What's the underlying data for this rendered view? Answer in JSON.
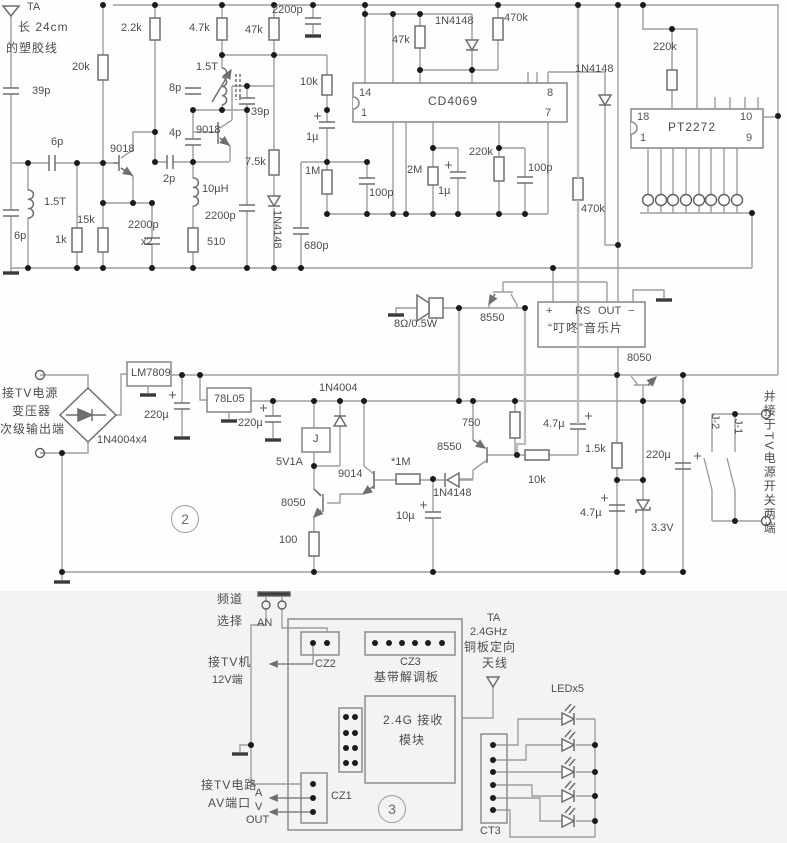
{
  "diagram_type": "circuit-schematic",
  "accent_colors": {
    "wire": "#9e9e9e",
    "routing_wire": "#bdbdbd",
    "symbol": "#6f6f6f",
    "junction_dot": "#1b1b1b",
    "text": "#4d4d4d",
    "lower_panel_bg": "#f3f3f1"
  },
  "icons": {
    "antenna": "antenna-icon",
    "ground": "ground-icon",
    "speaker": "speaker-icon",
    "led": "led-icon",
    "diode": "diode-icon",
    "transistor": "transistor-icon",
    "bridge-rectifier": "bridge-rectifier-icon",
    "relay-contact": "switch-contact-icon",
    "push-button": "push-button-icon"
  },
  "labels": {
    "osc": {
      "ta": "TA",
      "ant_note1": "长 24cm",
      "ant_note2": "的塑胶线",
      "c39p_a": "39p",
      "r20k": "20k",
      "c6p_a": "6p",
      "q9018_a": "9018",
      "l1t5_a": "1.5T",
      "c6p_b": "6p",
      "r1k": "1k",
      "r15k": "15k",
      "c2200p_x2": "2200p",
      "x2": "x2",
      "r2k2": "2.2k",
      "c2p": "2p",
      "l10uh": "10µH",
      "r510": "510",
      "c8p": "8p",
      "c4p": "4p",
      "q9018_b": "9018",
      "l1t5_b": "1.5T",
      "r4k7": "4.7k",
      "c39p_b": "39p",
      "c2200p_b": "2200p",
      "r7k5": "7.5k",
      "d1n4148_a": "1N4148",
      "r47k_a": "47k",
      "c2200p_a": "2200p",
      "c680p": "680p"
    },
    "cd": {
      "name": "CD4069",
      "pin14": "14",
      "pin1": "1",
      "pin8": "8",
      "pin7": "7",
      "r10k": "10k",
      "c1u_a": "1µ",
      "r1m": "1M",
      "c100p_a": "100p",
      "r2m": "2M",
      "c1u_b": "1µ",
      "r220k": "220k",
      "c100p_b": "100p",
      "r47k_b": "47k",
      "d1n4148_b": "1N4148",
      "r470k_a": "470k"
    },
    "pt": {
      "name": "PT2272",
      "pin18": "18",
      "pin1": "1",
      "pin10": "10",
      "pin9": "9",
      "r220k": "220k",
      "d1n4148": "1N4148",
      "r470k_b": "470k"
    },
    "audio": {
      "spk": "8Ω/0.5W",
      "q8550": "8550",
      "pin_plus": "+",
      "pin_rs": "RS",
      "pin_out": "OUT",
      "pin_minus": "−",
      "name": "“叮咚”音乐片",
      "q8050": "8050"
    },
    "psu": {
      "in1": "接TV电源",
      "in2": "变压器",
      "in3": "次级输出端",
      "bridge": "1N4004x4",
      "reg9": "LM7809",
      "c220u_a": "220µ",
      "reg5": "78L05",
      "c220u_b": "220µ",
      "d1n4004": "1N4004",
      "relay": "J",
      "v5v1a": "5V1A",
      "q9014": "9014",
      "r1m_star": "*1M",
      "q8550": "8550",
      "d1n4148": "1N4148",
      "r750": "750",
      "r10k_b": "10k",
      "c4u7_a": "4.7µ",
      "q8050_c": "8050",
      "r100": "100",
      "c10u": "10µ",
      "r1k5": "1.5k",
      "c4u7_b": "4.7µ",
      "d3v3": "3.3V",
      "c220u_c": "220µ",
      "j1": "J-1",
      "j2": "J-2",
      "note": "并接于TV电源开关两端"
    },
    "rx": {
      "ch1": "频道",
      "ch2": "选择",
      "btn": "AN",
      "tv1": "接TV机",
      "tv2": "12V端",
      "cz2": "CZ2",
      "cz3": "CZ3",
      "board": "基带解调板",
      "mod1": "2.4G 接收",
      "mod2": "模块",
      "cz1": "CZ1",
      "av1": "接TV电路",
      "av2": "AV端口",
      "a": "A",
      "v": "V",
      "out": "OUT",
      "ta": "TA",
      "ant1": "2.4GHz",
      "ant2": "铜板定向",
      "ant3": "天线",
      "led": "LEDx5",
      "ct3": "CT3"
    },
    "nums": {
      "power": "2",
      "rx": "3"
    }
  }
}
